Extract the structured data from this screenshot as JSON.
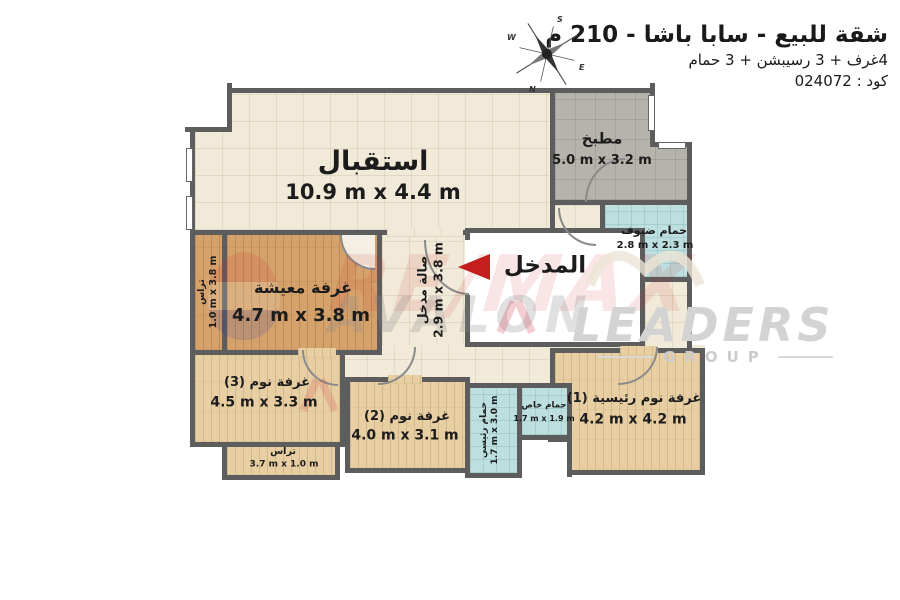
{
  "header": {
    "title": "شقة للبيع - سابا باشا - 210 م",
    "subtitle": "4غرف + 3 رسيبشن + 3 حمام",
    "code": "كود : 024072"
  },
  "compass": {
    "n": "N",
    "s": "S",
    "e": "E",
    "w": "W"
  },
  "watermarks": {
    "remax": "RE/MAX",
    "avalon": "AVALON",
    "leaders": "LEADERS",
    "group": "GROUP"
  },
  "entrance": {
    "label": "المدخل"
  },
  "rooms": {
    "reception": {
      "name": "استقبال",
      "dims": "10.9 m x 4.4 m"
    },
    "kitchen": {
      "name": "مطبخ",
      "dims": "5.0 m x 3.2 m"
    },
    "guest_bath": {
      "name": "حمام ضيوف",
      "dims": "2.8 m x 2.3 m"
    },
    "entrance_hall": {
      "name": "صالة مدخل",
      "dims": "2.9 m x 3.8 m"
    },
    "living": {
      "name": "غرفة معيشة",
      "dims": "4.7 m x 3.8 m"
    },
    "terrace_left": {
      "name": "تراس",
      "dims": "1.0 m x 3.8 m"
    },
    "bedroom3": {
      "name": "غرفة نوم (3)",
      "dims": "4.5 m x 3.3 m"
    },
    "terrace_bottom": {
      "name": "تراس",
      "dims": "3.7 m x 1.0 m"
    },
    "bedroom2": {
      "name": "غرفة نوم (2)",
      "dims": "4.0 m x 3.1 m"
    },
    "main_bath": {
      "name": "حمام رئيسي",
      "dims": "1.7 m x 3.0 m"
    },
    "private_bath": {
      "name": "حمام خاص",
      "dims": "1.7 m x 1.9 m"
    },
    "master_bedroom": {
      "name": "غرفة نوم رئيسية (1)",
      "dims": "4.2 m x 4.2 m"
    }
  },
  "colors": {
    "wall": "#5d5d5d",
    "cream": "#f1ead9",
    "gray": "#b6b3ac",
    "teal": "#bedfdf",
    "wood_dark": "#d5a26b",
    "wood_light": "#e7cfa3",
    "arrow_red": "#c41e1e"
  }
}
